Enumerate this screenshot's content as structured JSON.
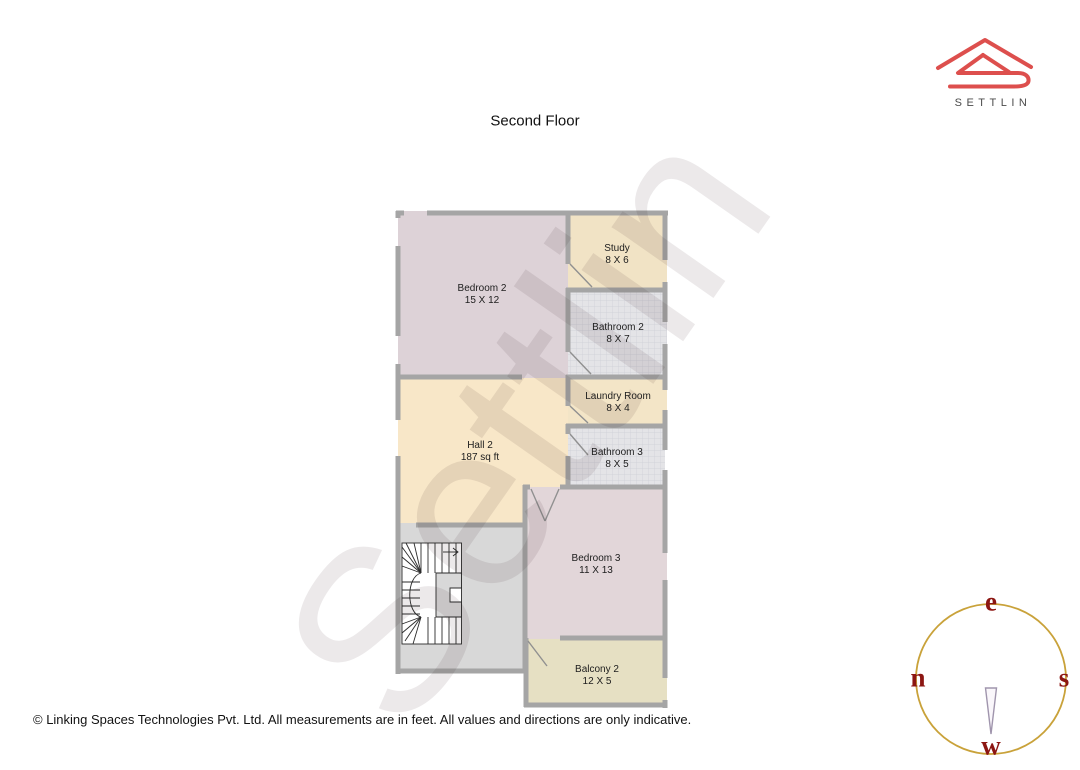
{
  "title": "Second Floor",
  "brand": {
    "name": "SETTLIN"
  },
  "watermark": "Settlin",
  "rooms": [
    {
      "name": "Bedroom 2",
      "dims": "15 X 12"
    },
    {
      "name": "Study",
      "dims": "8 X 6"
    },
    {
      "name": "Bathroom 2",
      "dims": "8 X 7"
    },
    {
      "name": "Laundry Room",
      "dims": "8 X 4"
    },
    {
      "name": "Hall 2",
      "dims": "187 sq ft"
    },
    {
      "name": "Bathroom 3",
      "dims": "8 X 5"
    },
    {
      "name": "Bedroom 3",
      "dims": "11 X 13"
    },
    {
      "name": "Balcony 2",
      "dims": "12 X 5"
    }
  ],
  "compass": {
    "top": "e",
    "right": "s",
    "bottom": "w",
    "left": "n"
  },
  "footer": "© Linking Spaces Technologies Pvt. Ltd. All measurements are in feet. All values and directions are only indicative.",
  "colors": {
    "logo_red": "#dd4f4d",
    "compass_ring": "#c9a23a",
    "compass_letters": "#8c1612",
    "wall_gray": "#a5a5a5"
  }
}
